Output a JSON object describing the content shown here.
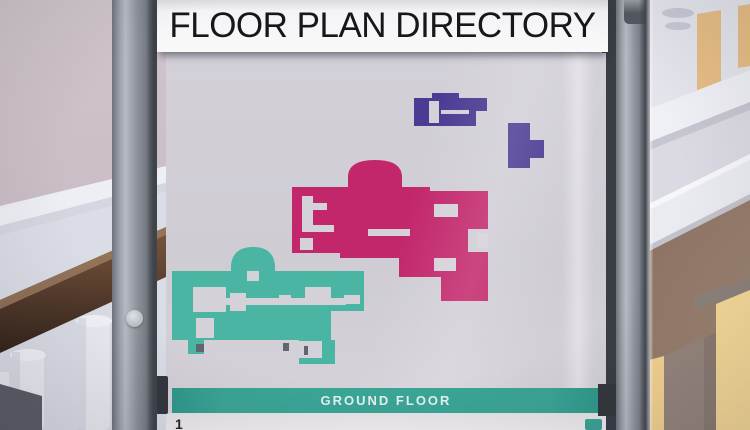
{
  "sign": {
    "title": "FLOOR PLAN DIRECTORY",
    "banner_label": "GROUND FLOOR",
    "legend_first_item_number": "1"
  },
  "plans": [
    {
      "name": "ground-floor-wing",
      "color": "#4ab5a3"
    },
    {
      "name": "first-floor-wing",
      "color": "#c2266b"
    },
    {
      "name": "second-floor-wing",
      "color": "#4c3a93"
    }
  ],
  "colors": {
    "plan_pink": "#c2266b",
    "plan_teal": "#4ab5a3",
    "plan_purple": "#4c3a93",
    "banner_teal": "#3aa596",
    "panel_grey": "#cfccd4",
    "post_grey": "#8e939c",
    "handrail_brown": "#52392a",
    "wall_warm": "#f2d194",
    "wall_mauve": "#c9bdc5"
  }
}
